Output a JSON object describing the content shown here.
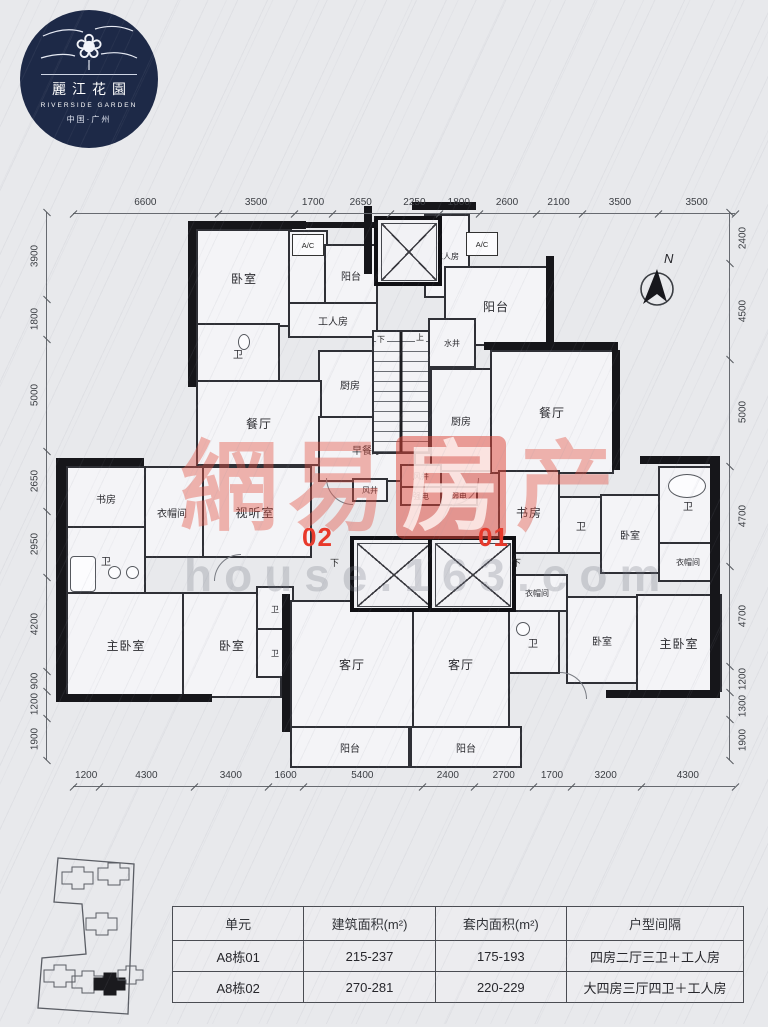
{
  "logo": {
    "name_zh": "麗江花園",
    "name_en": "RIVERSIDE GARDEN",
    "region": "中国·广州"
  },
  "compass": {
    "label": "N"
  },
  "watermark": {
    "chars": [
      "網",
      "易",
      "房",
      "产"
    ],
    "sub": "house.163.com"
  },
  "unit_labels": {
    "left": "02",
    "right": "01"
  },
  "room_labels": {
    "bedroom": "卧室",
    "master_bedroom": "主卧室",
    "living_room": "客厅",
    "dining_room": "餐厅",
    "breakfast_room": "早餐厅",
    "kitchen": "厨房",
    "balcony": "阳台",
    "bathroom": "卫",
    "study": "书房",
    "cloakroom": "衣帽间",
    "media_room": "视听室",
    "worker_room": "工人房",
    "water_well": "水井",
    "air_shaft": "风井",
    "strong_electric": "强电",
    "weak_electric": "弱电",
    "ac": "A/C",
    "up": "上",
    "down": "下"
  },
  "dimensions": {
    "top": [
      "6600",
      "3500",
      "1700",
      "2650",
      "2250",
      "1800",
      "2600",
      "2100",
      "3500",
      "3500"
    ],
    "bottom": [
      "1200",
      "4300",
      "3400",
      "1600",
      "5400",
      "2400",
      "2700",
      "1700",
      "3200",
      "4300"
    ],
    "left": [
      "3900",
      "1800",
      "5000",
      "2650",
      "2950",
      "4200",
      "900",
      "1200",
      "1900"
    ],
    "right": [
      "2400",
      "4500",
      "5000",
      "4700",
      "4700",
      "1200",
      "1300",
      "1900"
    ]
  },
  "table": {
    "headers": [
      "单元",
      "建筑面积(m²)",
      "套内面积(m²)",
      "户型间隔"
    ],
    "rows": [
      [
        "A8栋01",
        "215-237",
        "175-193",
        "四房二厅三卫＋工人房"
      ],
      [
        "A8栋02",
        "270-281",
        "220-229",
        "大四房三厅四卫＋工人房"
      ]
    ]
  }
}
